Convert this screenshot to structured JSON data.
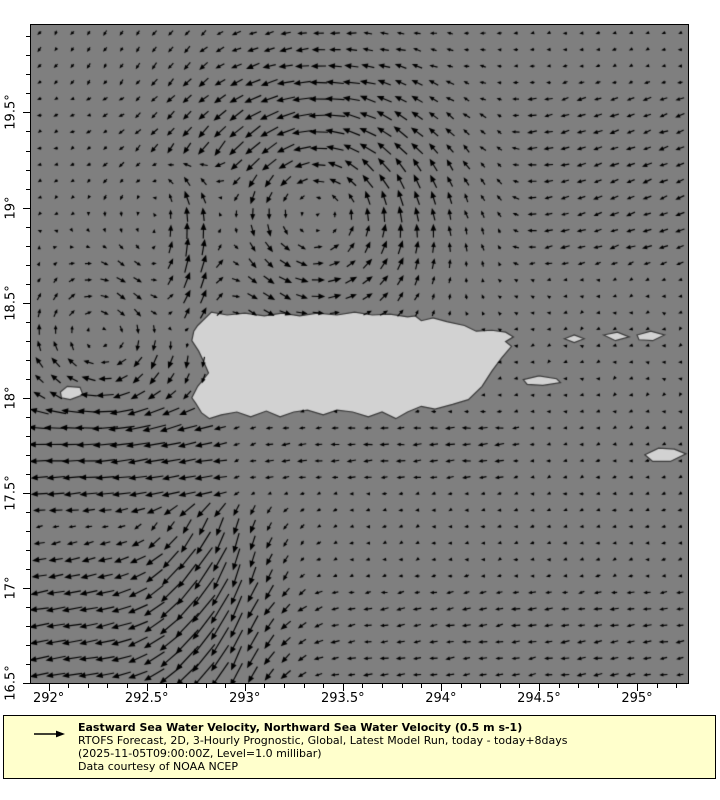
{
  "colors": {
    "page_bg": "#ffffff",
    "sea": "#7f7f7f",
    "land": "#d2d2d2",
    "land_outline": "#3a3a3a",
    "arrow": "#000000",
    "axis": "#000000",
    "legend_bg": "#ffffcc",
    "legend_border": "#000000",
    "text": "#000000"
  },
  "legend": {
    "title": "Eastward Sea Water Velocity, Northward Sea Water Velocity (0.5 m s-1)",
    "subtitle": "RTOFS Forecast, 2D, 3-Hourly Prognostic, Global, Latest Model Run, today - today+8days",
    "run_info": "(2025-11-05T09:00:00Z, Level=1.0 millibar)",
    "credit": "Data courtesy of NOAA NCEP",
    "reference_arrow": "right-arrow"
  },
  "axes": {
    "x_ticks": [
      {
        "value": 292.0,
        "label": "292°"
      },
      {
        "value": 292.5,
        "label": "292.5°"
      },
      {
        "value": 293.0,
        "label": "293°"
      },
      {
        "value": 293.5,
        "label": "293.5°"
      },
      {
        "value": 294.0,
        "label": "294°"
      },
      {
        "value": 294.5,
        "label": "294.5°"
      },
      {
        "value": 295.0,
        "label": "295°"
      }
    ],
    "y_ticks": [
      {
        "value": 19.5,
        "label": "19.5°"
      },
      {
        "value": 19.0,
        "label": "19°"
      },
      {
        "value": 18.5,
        "label": "18.5°"
      },
      {
        "value": 18.0,
        "label": "18°"
      },
      {
        "value": 17.5,
        "label": "17.5°"
      },
      {
        "value": 17.0,
        "label": "17°"
      },
      {
        "value": 16.5,
        "label": "16.5°"
      }
    ],
    "minor_step": 0.1,
    "major_tick_len": 7,
    "minor_tick_len": 4
  },
  "chart_data": {
    "type": "quiver",
    "title": "Eastward Sea Water Velocity, Northward Sea Water Velocity",
    "units": "m s-1",
    "reference_value_m_s": 0.5,
    "x_range": [
      291.91,
      295.26
    ],
    "y_range": [
      16.5,
      19.96
    ],
    "grid": {
      "nx": 40,
      "ny": 40
    },
    "scale_px_per_m_s": 46,
    "background_flow": {
      "u": -0.08,
      "v": -0.02
    },
    "features": [
      {
        "type": "eddy",
        "rotation": "ccw",
        "center": [
          293.35,
          19.02
        ],
        "radius": 0.62,
        "strength": 0.42
      },
      {
        "type": "eddy",
        "rotation": "cw",
        "center": [
          292.28,
          18.28
        ],
        "radius": 0.42,
        "strength": 0.3
      },
      {
        "type": "jet",
        "name": "mona-passage-north-jet",
        "lon": 292.74,
        "width": 0.21,
        "lat_min": 18.25,
        "lat_max": 19.3,
        "u": 0.0,
        "v": 0.75
      },
      {
        "type": "jet",
        "name": "south-outflow-jet",
        "lon": 292.85,
        "width": 0.32,
        "lat_min": 16.2,
        "lat_max": 17.5,
        "u": -0.08,
        "v": -0.58
      },
      {
        "type": "drift",
        "name": "west-passage-band",
        "box": [
          291.7,
          17.3,
          292.98,
          18.03
        ],
        "u": -0.28,
        "v": -0.02
      },
      {
        "type": "drift",
        "name": "southwest-corner",
        "box": [
          291.7,
          16.3,
          292.95,
          17.33
        ],
        "u": -0.24,
        "v": -0.04
      },
      {
        "type": "drift",
        "name": "south-coast-band",
        "box": [
          292.95,
          17.48,
          294.45,
          17.98
        ],
        "u": -0.13,
        "v": 0.0
      },
      {
        "type": "drift",
        "name": "bottom-band",
        "box": [
          291.7,
          16.3,
          295.4,
          17.08
        ],
        "u": -0.1,
        "v": -0.01
      },
      {
        "type": "drift",
        "name": "northeast-region",
        "box": [
          294.3,
          18.6,
          295.4,
          19.7
        ],
        "u": -0.11,
        "v": -0.05
      },
      {
        "type": "drift",
        "name": "northwest-corner",
        "box": [
          291.7,
          19.55,
          292.9,
          20.1
        ],
        "u": 0.02,
        "v": -0.07
      },
      {
        "type": "damp",
        "name": "east-quiet-zone",
        "box": [
          294.38,
          17.85,
          295.4,
          18.72
        ],
        "factor": 0.5
      }
    ],
    "land": [
      {
        "name": "puerto-rico",
        "points": [
          [
            292.76,
            18.38
          ],
          [
            292.83,
            18.45
          ],
          [
            292.91,
            18.435
          ],
          [
            293.0,
            18.445
          ],
          [
            293.1,
            18.43
          ],
          [
            293.19,
            18.445
          ],
          [
            293.28,
            18.43
          ],
          [
            293.37,
            18.445
          ],
          [
            293.47,
            18.435
          ],
          [
            293.56,
            18.45
          ],
          [
            293.65,
            18.435
          ],
          [
            293.74,
            18.44
          ],
          [
            293.83,
            18.425
          ],
          [
            293.87,
            18.43
          ],
          [
            293.9,
            18.405
          ],
          [
            293.96,
            18.42
          ],
          [
            294.03,
            18.4
          ],
          [
            294.12,
            18.38
          ],
          [
            294.18,
            18.35
          ],
          [
            294.26,
            18.355
          ],
          [
            294.33,
            18.345
          ],
          [
            294.37,
            18.32
          ],
          [
            294.33,
            18.295
          ],
          [
            294.36,
            18.27
          ],
          [
            294.31,
            18.21
          ],
          [
            294.26,
            18.14
          ],
          [
            294.21,
            18.06
          ],
          [
            294.14,
            17.99
          ],
          [
            294.06,
            17.965
          ],
          [
            293.97,
            17.94
          ],
          [
            293.9,
            17.955
          ],
          [
            293.83,
            17.925
          ],
          [
            293.77,
            17.89
          ],
          [
            293.7,
            17.925
          ],
          [
            293.63,
            17.9
          ],
          [
            293.55,
            17.925
          ],
          [
            293.47,
            17.935
          ],
          [
            293.4,
            17.91
          ],
          [
            293.32,
            17.935
          ],
          [
            293.25,
            17.925
          ],
          [
            293.18,
            17.9
          ],
          [
            293.11,
            17.93
          ],
          [
            293.03,
            17.9
          ],
          [
            292.96,
            17.925
          ],
          [
            292.88,
            17.91
          ],
          [
            292.82,
            17.89
          ],
          [
            292.78,
            17.92
          ],
          [
            292.75,
            17.97
          ],
          [
            292.73,
            18.0
          ],
          [
            292.76,
            18.06
          ],
          [
            292.815,
            18.13
          ],
          [
            292.79,
            18.19
          ],
          [
            292.765,
            18.245
          ],
          [
            292.73,
            18.3
          ],
          [
            292.74,
            18.35
          ]
        ]
      },
      {
        "name": "mona-island",
        "points": [
          [
            292.06,
            18.03
          ],
          [
            292.095,
            18.06
          ],
          [
            292.16,
            18.055
          ],
          [
            292.175,
            18.015
          ],
          [
            292.11,
            17.99
          ],
          [
            292.065,
            18.0
          ]
        ]
      },
      {
        "name": "vieques",
        "points": [
          [
            294.42,
            18.095
          ],
          [
            294.5,
            18.115
          ],
          [
            294.59,
            18.1
          ],
          [
            294.61,
            18.08
          ],
          [
            294.52,
            18.065
          ],
          [
            294.44,
            18.07
          ]
        ]
      },
      {
        "name": "culebra",
        "points": [
          [
            294.63,
            18.31
          ],
          [
            294.68,
            18.33
          ],
          [
            294.73,
            18.31
          ],
          [
            294.68,
            18.29
          ]
        ]
      },
      {
        "name": "st-thomas",
        "points": [
          [
            294.83,
            18.33
          ],
          [
            294.9,
            18.345
          ],
          [
            294.96,
            18.32
          ],
          [
            294.89,
            18.3
          ]
        ]
      },
      {
        "name": "tortola",
        "points": [
          [
            295.0,
            18.33
          ],
          [
            295.07,
            18.35
          ],
          [
            295.14,
            18.33
          ],
          [
            295.08,
            18.3
          ],
          [
            295.01,
            18.305
          ]
        ]
      },
      {
        "name": "st-croix",
        "points": [
          [
            295.04,
            17.7
          ],
          [
            295.11,
            17.735
          ],
          [
            295.19,
            17.73
          ],
          [
            295.25,
            17.705
          ],
          [
            295.17,
            17.665
          ],
          [
            295.08,
            17.665
          ]
        ]
      }
    ]
  }
}
